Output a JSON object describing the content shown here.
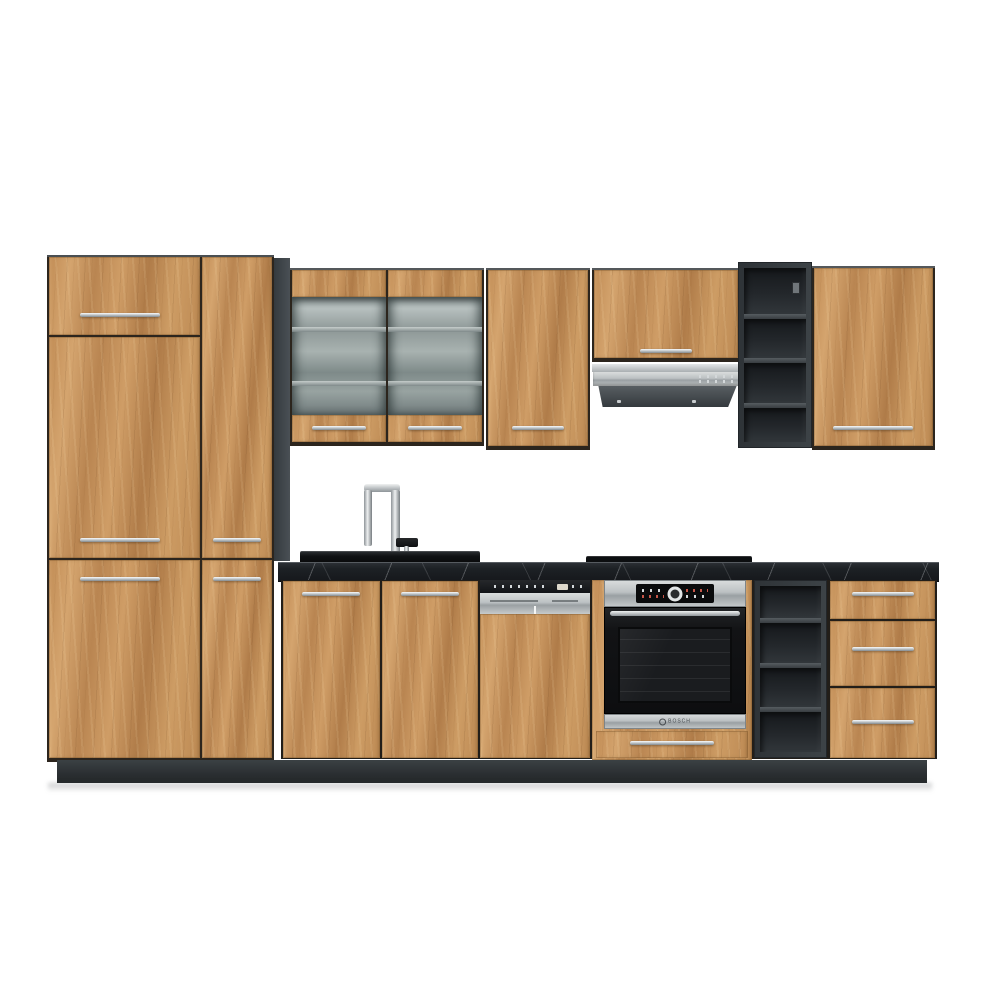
{
  "scene": {
    "type": "product-photo",
    "subject": "modular kitchen furniture set with oak-effect fronts and anthracite carcass",
    "background": "#ffffff"
  },
  "palette": {
    "wood": "#c6935d",
    "wood_light": "#d6aa74",
    "wood_dark": "#a87947",
    "carcass": "#343a3e",
    "plinth": "#2b2f32",
    "countertop": "#16181c",
    "marble_vein": "#d8dcdf",
    "chrome": "#eef0f1",
    "steel": "#b7bcbf",
    "appliance_black": "#141619",
    "glass": "#96a09f"
  },
  "components": {
    "tall_cabinet": {
      "name": "tall pantry unit",
      "columns": 2,
      "doors": 5,
      "handle_finish": "chrome"
    },
    "glass_wall_cabinet": {
      "doors": 2,
      "glass_front": true,
      "interior_shelves": 2
    },
    "wall_cabinet_left": {
      "doors": 1
    },
    "hood_wall_cabinet": {
      "doors": 1
    },
    "range_hood": {
      "type": "under-cabinet slide-out hood",
      "finish": "stainless"
    },
    "wall_open_shelf": {
      "compartments": 4,
      "color_name": "anthracite"
    },
    "wall_cabinet_right": {
      "doors": 1
    },
    "faucet": {
      "finish": "chrome",
      "shape": "squared gooseneck"
    },
    "sink": {
      "type": "inset black sink"
    },
    "worktop": {
      "material": "black marble-effect"
    },
    "hob": {
      "type": "flush black hob"
    },
    "sink_base_cabinet": {
      "doors": 2
    },
    "dishwasher": {
      "type": "semi-integrated, furniture front",
      "panel_finish": "stainless"
    },
    "oven": {
      "brand": "BOSCH",
      "type": "built-in single oven",
      "display": "red LED",
      "knob": "central dial"
    },
    "oven_housing": {
      "drawers": 1
    },
    "base_open_shelf": {
      "compartments": 4,
      "color_name": "anthracite"
    },
    "drawer_base_cabinet": {
      "drawers": 3
    },
    "plinth": {
      "color_name": "anthracite"
    }
  }
}
